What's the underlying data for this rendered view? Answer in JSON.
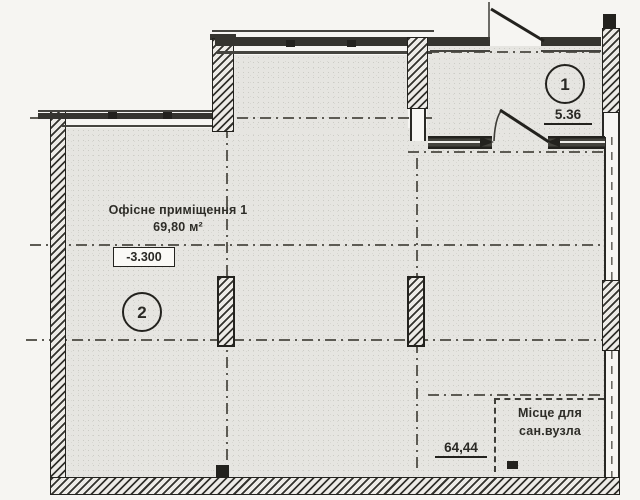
{
  "drawing": {
    "office": {
      "name": "Офісне приміщення 1",
      "area": "69,80 м²",
      "elevation": "-3.300",
      "badge": "2"
    },
    "entry": {
      "badge": "1",
      "width_dim": "5.36"
    },
    "bottom_dim": "64,44",
    "sanitary": {
      "line1": "Місце для",
      "line2": "сан.вузла"
    },
    "colors": {
      "ink": "#23221e",
      "floor_fill": "#e6e5e1",
      "paper": "#f6f5f2"
    }
  }
}
